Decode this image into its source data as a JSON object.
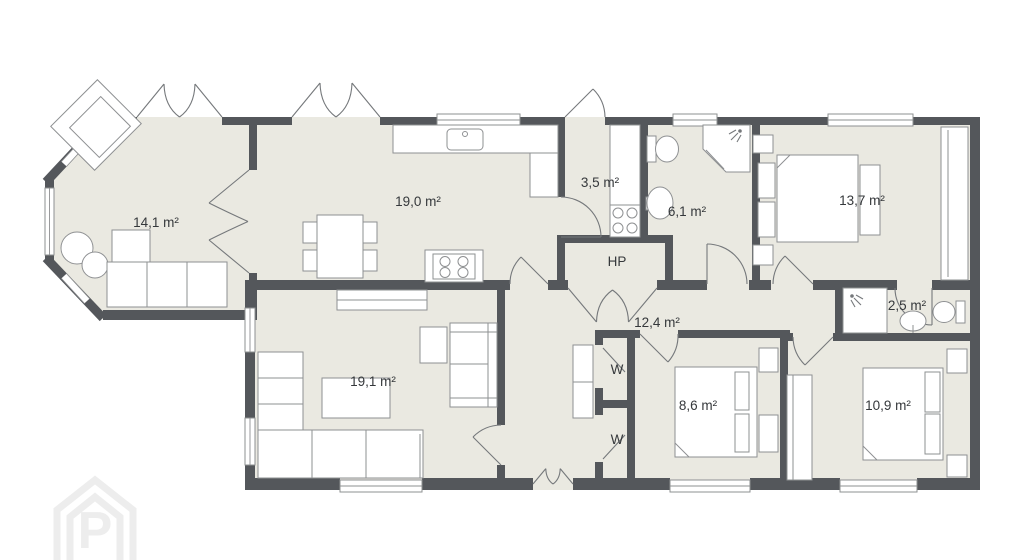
{
  "palette": {
    "wall": "#54575b",
    "floor": "#eae9e1",
    "line": "#8e9092",
    "arc": "#75787b",
    "label": "#35383b",
    "wm": "#ededed"
  },
  "rooms": {
    "living_bay": {
      "label": "14,1 m²"
    },
    "kitchen": {
      "label": "19,0 m²"
    },
    "utility": {
      "label": "3,5 m²"
    },
    "bath": {
      "label": "6,1 m²"
    },
    "bedroom_large": {
      "label": "13,7 m²"
    },
    "hp": {
      "label": "HP"
    },
    "wc": {
      "label": "2,5 m²"
    },
    "hallway": {
      "label": "12,4 m²"
    },
    "living": {
      "label": "19,1 m²"
    },
    "wardrobe_top": {
      "label": "W"
    },
    "wardrobe_bottom": {
      "label": "W"
    },
    "bedroom_mid": {
      "label": "8,6 m²"
    },
    "bedroom_right": {
      "label": "10,9 m²"
    }
  },
  "watermark": {
    "letter": "P"
  }
}
